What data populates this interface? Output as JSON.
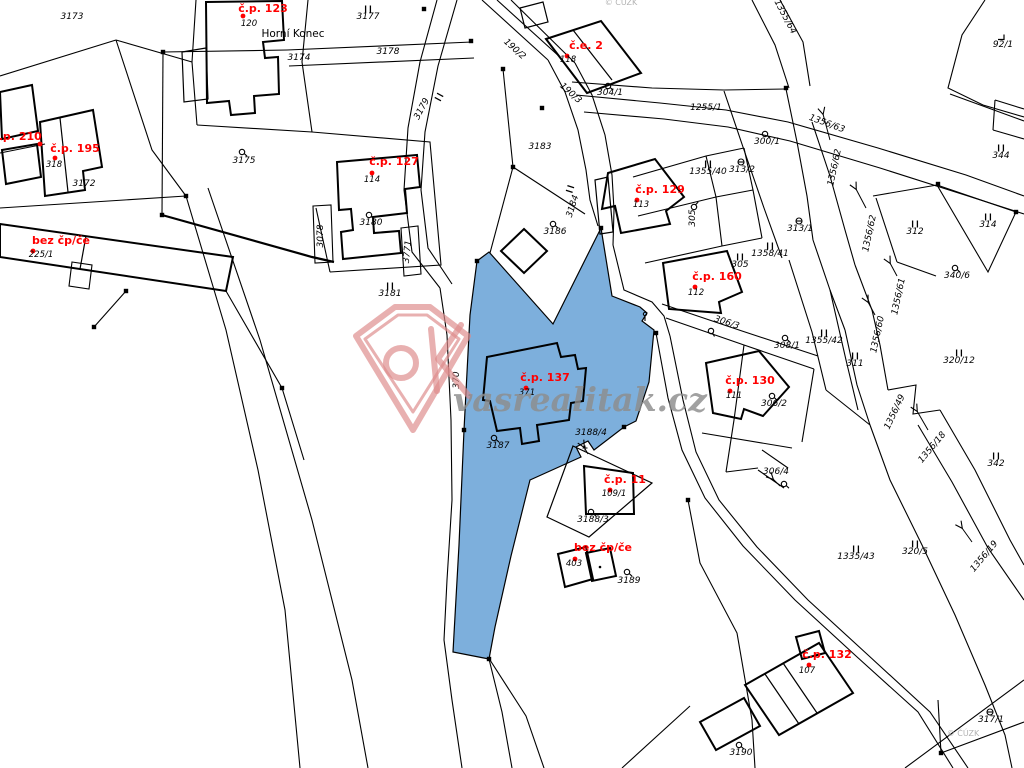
{
  "map": {
    "place_name": "Horní Konec",
    "selected_parcel": {
      "number": "3187",
      "building": "371",
      "house_label": "č.p. 137",
      "fill": "#7dafdc"
    },
    "colors": {
      "highlight_fill": "#7dafdc",
      "house_label_red": "#ff0000",
      "line_black": "#000000",
      "watermark_pink": "#dd8a8a",
      "watermark_grey": "#8d8d8d"
    },
    "icons": {
      "landuse_circle": "building-plot-icon",
      "double_bar": "meadow-icon",
      "circle_bar": "garden-icon",
      "arrow": "slope-arrow-icon",
      "square": "boundary-point-icon"
    },
    "labels": [
      {
        "t": "3173"
      },
      {
        "t": "3174"
      },
      {
        "t": "3177"
      },
      {
        "t": "3178"
      },
      {
        "t": "3179"
      },
      {
        "t": "3172"
      },
      {
        "t": "3175"
      },
      {
        "t": "3078"
      },
      {
        "t": "3180"
      },
      {
        "t": "3771"
      },
      {
        "t": "3181"
      },
      {
        "t": "370"
      },
      {
        "t": "3183"
      },
      {
        "t": "3184"
      },
      {
        "t": "3186"
      },
      {
        "t": "190/2"
      },
      {
        "t": "190/3"
      },
      {
        "t": "304/1"
      },
      {
        "t": "1255/1"
      },
      {
        "t": "1355/64"
      },
      {
        "t": "1356/63"
      },
      {
        "t": "300/1"
      },
      {
        "t": "1355/40"
      },
      {
        "t": "313/2"
      },
      {
        "t": "313/1"
      },
      {
        "t": "1358/41"
      },
      {
        "t": "305"
      },
      {
        "t": "305"
      },
      {
        "t": "1356/62"
      },
      {
        "t": "1356/62"
      },
      {
        "t": "1356/61"
      },
      {
        "t": "1356/60"
      },
      {
        "t": "312"
      },
      {
        "t": "344"
      },
      {
        "t": "92/1"
      },
      {
        "t": "314"
      },
      {
        "t": "340/6"
      },
      {
        "t": "306/3"
      },
      {
        "t": "308/1"
      },
      {
        "t": "1355/42"
      },
      {
        "t": "311"
      },
      {
        "t": "320/12"
      },
      {
        "t": "306/2"
      },
      {
        "t": "306/4"
      },
      {
        "t": "3187"
      },
      {
        "t": "3188/4"
      },
      {
        "t": "3188/3"
      },
      {
        "t": "3189"
      },
      {
        "t": "1335/43"
      },
      {
        "t": "320/5"
      },
      {
        "t": "342"
      },
      {
        "t": "1356/49"
      },
      {
        "t": "1356/18"
      },
      {
        "t": "1356/19"
      },
      {
        "t": "3190"
      },
      {
        "t": "317/1"
      }
    ],
    "houses": [
      {
        "label": "č.p. 123",
        "parcel": "120"
      },
      {
        "label": "č.p. 210",
        "parcel": ""
      },
      {
        "label": "č.p. 195",
        "parcel": "318"
      },
      {
        "label": "bez čp/če",
        "parcel": "225/1"
      },
      {
        "label": "č.p. 127",
        "parcel": "114"
      },
      {
        "label": "č.e. 2",
        "parcel": "118"
      },
      {
        "label": "č.p. 129",
        "parcel": "113"
      },
      {
        "label": "č.p. 160",
        "parcel": "112"
      },
      {
        "label": "č.p. 130",
        "parcel": "111"
      },
      {
        "label": "č.p. 137",
        "parcel": "371"
      },
      {
        "label": "č.p. 11",
        "parcel": "109/1"
      },
      {
        "label": "bez čp/če",
        "parcel": "403"
      },
      {
        "label": "č.p. 132",
        "parcel": "107"
      }
    ]
  },
  "watermark": {
    "site": "vasrealitak.cz",
    "logo_text": "OK",
    "copyright": "© ČÚZK",
    "copyright_top": "© ČÚZK"
  }
}
